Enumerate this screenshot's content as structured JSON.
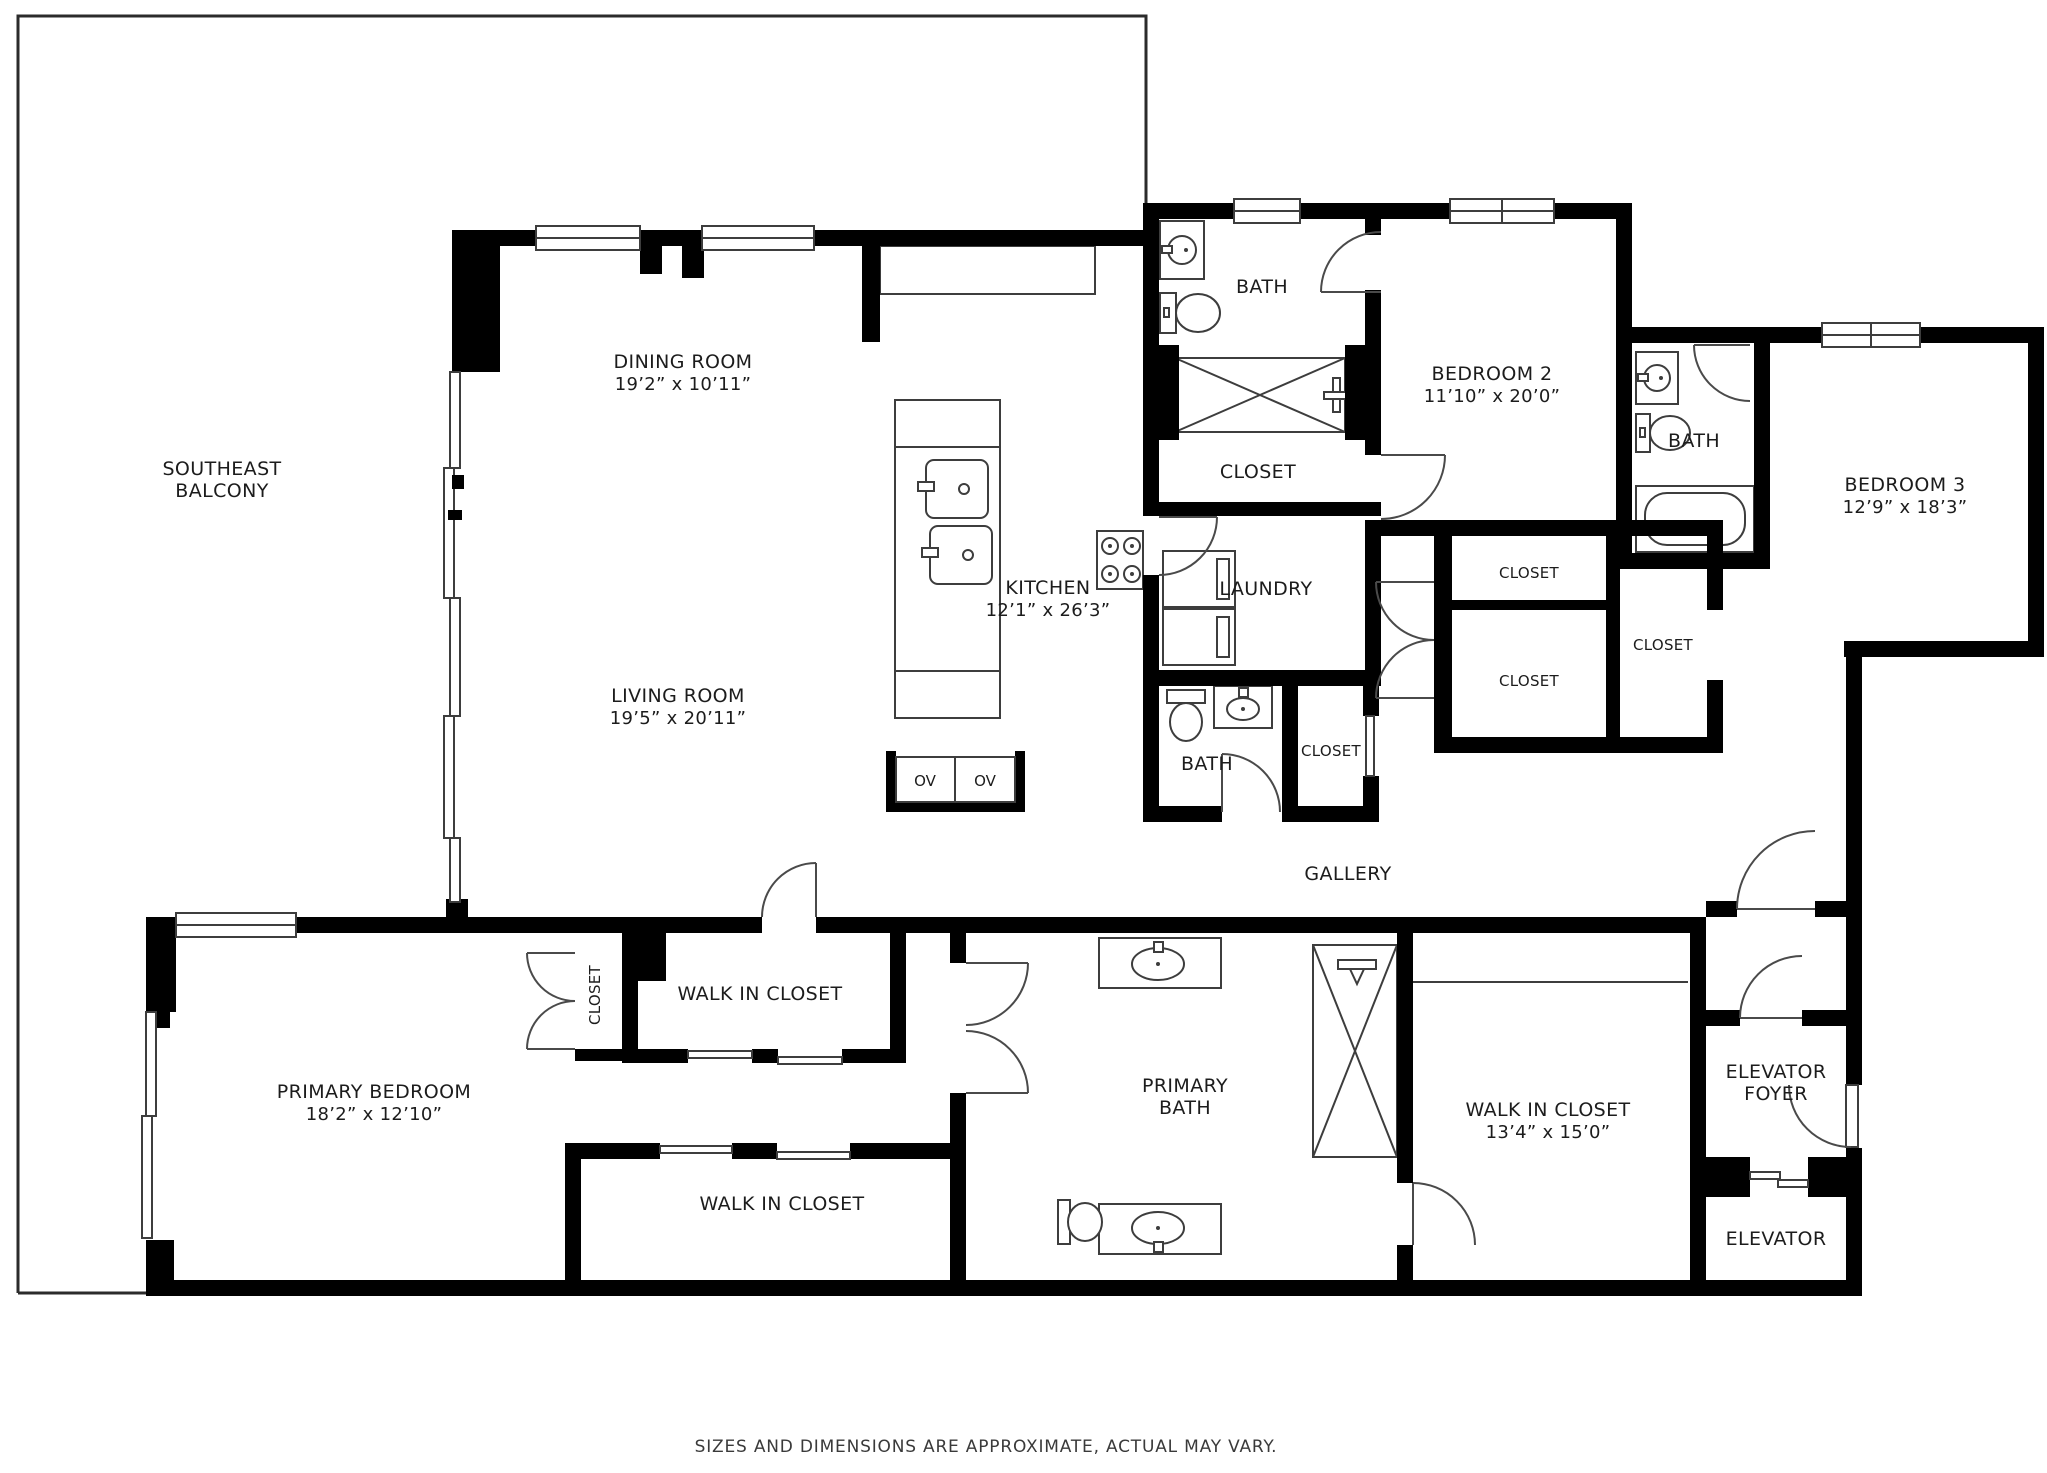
{
  "page": {
    "background": "#ffffff",
    "wall_color": "#000000",
    "line_color": "#3d3d3d",
    "text_color": "#1c1c1c"
  },
  "rooms": {
    "balcony": {
      "line1": "SOUTHEAST",
      "line2": "BALCONY"
    },
    "dining_room": {
      "name": "DINING ROOM",
      "dims": "19’2” x 10’11”"
    },
    "kitchen": {
      "name": "KITCHEN",
      "dims": "12’1” x 26’3”"
    },
    "living_room": {
      "name": "LIVING ROOM",
      "dims": "19’5” x 20’11”"
    },
    "bath_top": {
      "name": "BATH"
    },
    "closet_top": {
      "name": "CLOSET"
    },
    "laundry": {
      "name": "LAUNDRY"
    },
    "bath_hall": {
      "name": "BATH"
    },
    "closet_hall": {
      "name": "CLOSET"
    },
    "bedroom2": {
      "name": "BEDROOM 2",
      "dims": "11’10” x 20’0”"
    },
    "closet_bedroom2_a": {
      "name": "CLOSET"
    },
    "closet_bedroom2_b": {
      "name": "CLOSET"
    },
    "closet_bedroom3": {
      "name": "CLOSET"
    },
    "bath_bedroom3": {
      "name": "BATH"
    },
    "bedroom3": {
      "name": "BEDROOM 3",
      "dims": "12’9” x 18’3”"
    },
    "gallery": {
      "name": "GALLERY"
    },
    "primary_bedroom": {
      "name": "PRIMARY BEDROOM",
      "dims": "18’2” x 12’10”"
    },
    "closet_primary": {
      "name": "CLOSET"
    },
    "wic_upper": {
      "name": "WALK IN CLOSET"
    },
    "wic_lower": {
      "name": "WALK IN CLOSET"
    },
    "primary_bath": {
      "line1": "PRIMARY",
      "line2": "BATH"
    },
    "wic_main": {
      "name": "WALK IN CLOSET",
      "dims": "13’4” x 15’0”"
    },
    "elevator_foyer": {
      "line1": "ELEVATOR",
      "line2": "FOYER"
    },
    "elevator": {
      "name": "ELEVATOR"
    }
  },
  "appliances": {
    "oven_left": "OV",
    "oven_right": "OV"
  },
  "icons": {
    "sink": "oval-basin",
    "toilet": "tank-and-bowl",
    "bathtub": "rounded-rect-tub",
    "shower": "x-crossed-box",
    "washer_dryer": "stacked-squares",
    "stove": "four-burner-circles",
    "double_oven": "two-cell-box"
  },
  "footer": {
    "disclaimer": "SIZES AND DIMENSIONS ARE APPROXIMATE, ACTUAL MAY VARY."
  }
}
